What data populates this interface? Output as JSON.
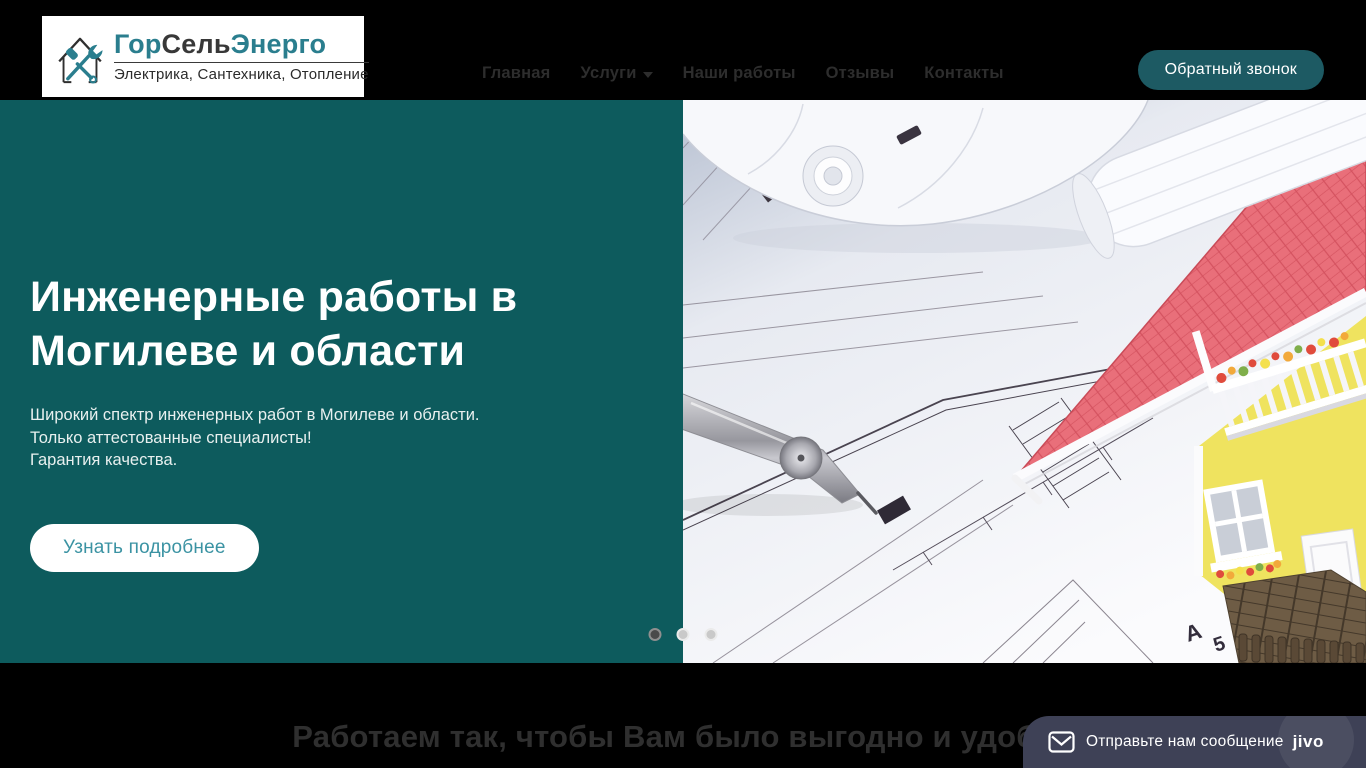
{
  "header": {
    "logo": {
      "name_part1": "Гор",
      "name_part2": "Сель",
      "name_part3": "Энерго",
      "tagline": "Электрика, Сантехника, Отопление"
    },
    "nav": [
      {
        "label": "Главная"
      },
      {
        "label": "Услуги"
      },
      {
        "label": "Наши работы"
      },
      {
        "label": "Отзывы"
      },
      {
        "label": "Контакты"
      }
    ],
    "callback_button": "Обратный звонок"
  },
  "hero": {
    "title": "Инженерные работы в Могилеве и области",
    "line1": "Широкий спектр инженерных работ в Могилеве и области.",
    "line2": "Только аттестованные специалисты!",
    "line3": "Гарантия качества.",
    "cta": "Узнать подробнее",
    "slide_count": 3,
    "active_slide": 1
  },
  "benefits": {
    "heading": "Работаем так, чтобы Вам было выгодно и удобно"
  },
  "chat": {
    "message": "Отправьте нам сообщение",
    "brand": "jivo"
  },
  "colors": {
    "header_bg": "#000000",
    "hero_teal": "#0d5b5d",
    "accent_teal": "#1d5a63",
    "logo_teal": "#2a7e8e",
    "cta_text": "#3b93a3",
    "nav_text": "#2d2d2d",
    "section_heading": "#2f2f2f",
    "chat_bg": "#3e4156",
    "roof_red": "#e96f7a",
    "house_yellow": "#efe35f"
  }
}
